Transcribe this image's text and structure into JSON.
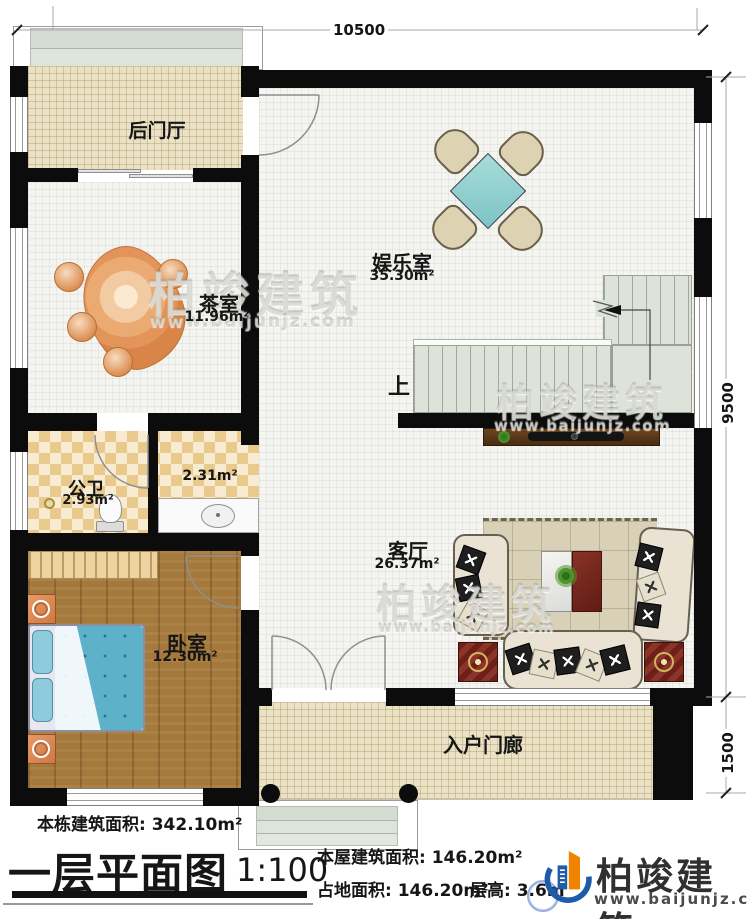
{
  "plan": {
    "dim_top": "10500",
    "dim_right_main": "9500",
    "dim_right_porch": "1500",
    "stair_up_label": "上",
    "rooms": {
      "back_hall": {
        "name": "后门厅"
      },
      "tea": {
        "name": "茶室",
        "area": "11.96m²"
      },
      "ent": {
        "name": "娱乐室",
        "area": "35.30m²"
      },
      "bath": {
        "name": "公卫",
        "area": "2.93m²"
      },
      "vest": {
        "area": "2.31m²"
      },
      "bed": {
        "name": "卧室",
        "area": "12.30m²"
      },
      "living": {
        "name": "客厅",
        "area": "26.37m²"
      },
      "porch": {
        "name": "入户门廊"
      }
    }
  },
  "title_block": {
    "total_area": "本栋建筑面积: 342.10m²",
    "floor_title": "一层平面图",
    "scale": "1:100",
    "house_area": "本屋建筑面积: 146.20m²",
    "land_area": "占地面积: 146.20m²",
    "floor_height": "层高: 3.6m"
  },
  "brand": {
    "name": "柏竣建筑",
    "url": "www.baijunjz.com"
  },
  "watermark": {
    "name": "柏竣建筑",
    "url": "www.baijunjz.com"
  },
  "colors": {
    "wall": "#0c0c0c",
    "floor_beige": "#ebe2c6",
    "floor_checker": "#e9c98c",
    "wood_floor": "#a5793c",
    "stair": "#dde3d8",
    "card_table_teal": "#97d4d6",
    "bed_blue": "#5db1c9",
    "accent_dark_red": "#6e2018",
    "brand_blue": "#1c5ca8",
    "brand_orange": "#f08300"
  }
}
